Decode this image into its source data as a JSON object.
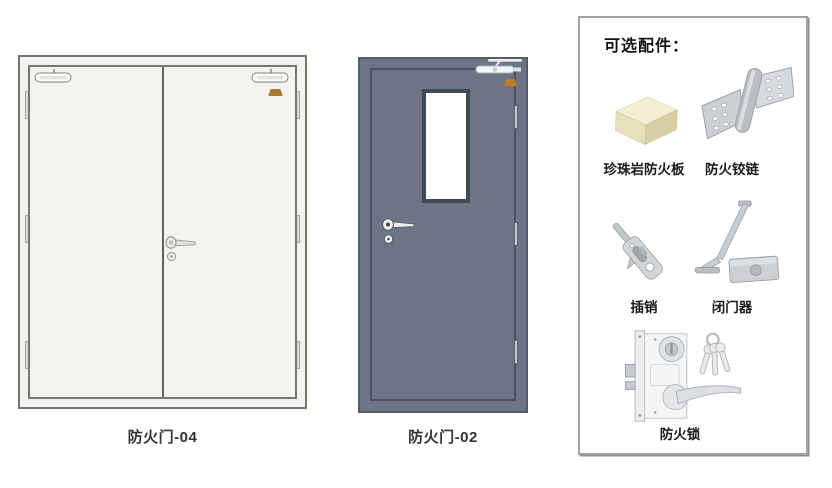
{
  "page": {
    "background": "#ffffff"
  },
  "doors": [
    {
      "name": "double-fire-door",
      "label": "防火门-04",
      "type": "double-leaf",
      "body_color": "#f3f2ee",
      "line_color": "#77776f",
      "logo_color": "#a87c33",
      "hardware": [
        "door-closer-left-leaf",
        "door-closer-right-leaf",
        "three-hinges-each-side",
        "lever-handle",
        "cylinder-keyhole",
        "brand-logo"
      ]
    },
    {
      "name": "single-fire-door",
      "label": "防火门-02",
      "type": "single-leaf-with-vision-panel",
      "body_color": "#6b7584",
      "line_color": "#4b5362",
      "logo_color": "#bf7e26",
      "hardware": [
        "door-closer-top-right",
        "vision-glass-panel",
        "three-hinges-right-side",
        "lever-handle",
        "cylinder-keyhole",
        "brand-logo"
      ]
    }
  ],
  "accessories_panel": {
    "title": "可选配件：",
    "items": [
      {
        "name": "perlite-fire-board",
        "label": "珍珠岩防火板",
        "icon": "cream-board-block-icon"
      },
      {
        "name": "fire-hinge",
        "label": "防火铰链",
        "icon": "flag-hinge-icon"
      },
      {
        "name": "flush-bolt",
        "label": "插销",
        "icon": "flush-bolt-icon"
      },
      {
        "name": "door-closer",
        "label": "闭门器",
        "icon": "door-closer-icon"
      },
      {
        "name": "fire-lock",
        "label": "防火锁",
        "icon": "mortise-lock-with-keys-icon"
      }
    ]
  },
  "colors": {
    "panel_border": "#a2a2a2",
    "board_cream": "#f3efd3",
    "metal_gray": "#cdd1d4",
    "label_text": "#1a1a1a"
  }
}
